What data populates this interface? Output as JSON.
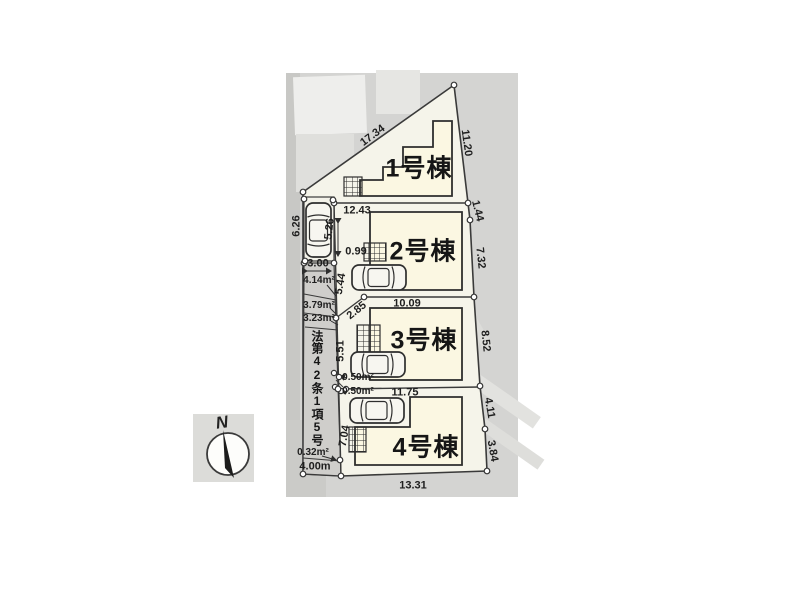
{
  "plan": {
    "buildings": [
      {
        "name": "1号棟"
      },
      {
        "name": "2号棟"
      },
      {
        "name": "3号棟"
      },
      {
        "name": "4号棟"
      }
    ],
    "dims": {
      "edge_top": "17.34",
      "edge_right_1": "11.20",
      "edge_right_2": "1.44",
      "edge_right_3": "7.32",
      "edge_right_4": "8.52",
      "edge_right_5": "4.11",
      "edge_right_6": "3.84",
      "edge_left": "6.26",
      "edge_bottom": "13.31",
      "road_bottom": "4.00m",
      "lot2_top": "12.43",
      "lot3_top": "10.09",
      "lot4_top": "11.75",
      "parking_len": "5.26",
      "parking_gap": "0.99",
      "road_width": "3.00",
      "road_seg_1": "5.44",
      "road_seg_2": "2.85",
      "road_seg_3": "5.51",
      "road_seg_4": "7.04"
    },
    "areas": {
      "share_1": "4.14m²",
      "share_2": "3.79m²",
      "share_3": "3.23m²",
      "corner_1": "0.50m²",
      "corner_2": "0.50m²",
      "corner_3": "0.32m²"
    },
    "road_designation": "法第42条1項5号"
  },
  "compass": {
    "north_label": "N"
  },
  "icons": {
    "car": "car-top-view",
    "entrance": "hatched-porch",
    "north_arrow": "compass-needle"
  },
  "colors": {
    "road_gray": "#cfcecb",
    "lot_fill": "#f5f4ea",
    "building_fill": "#fbf7e2",
    "line": "#3a3a3a",
    "map_bg": "#d4d4d2"
  }
}
